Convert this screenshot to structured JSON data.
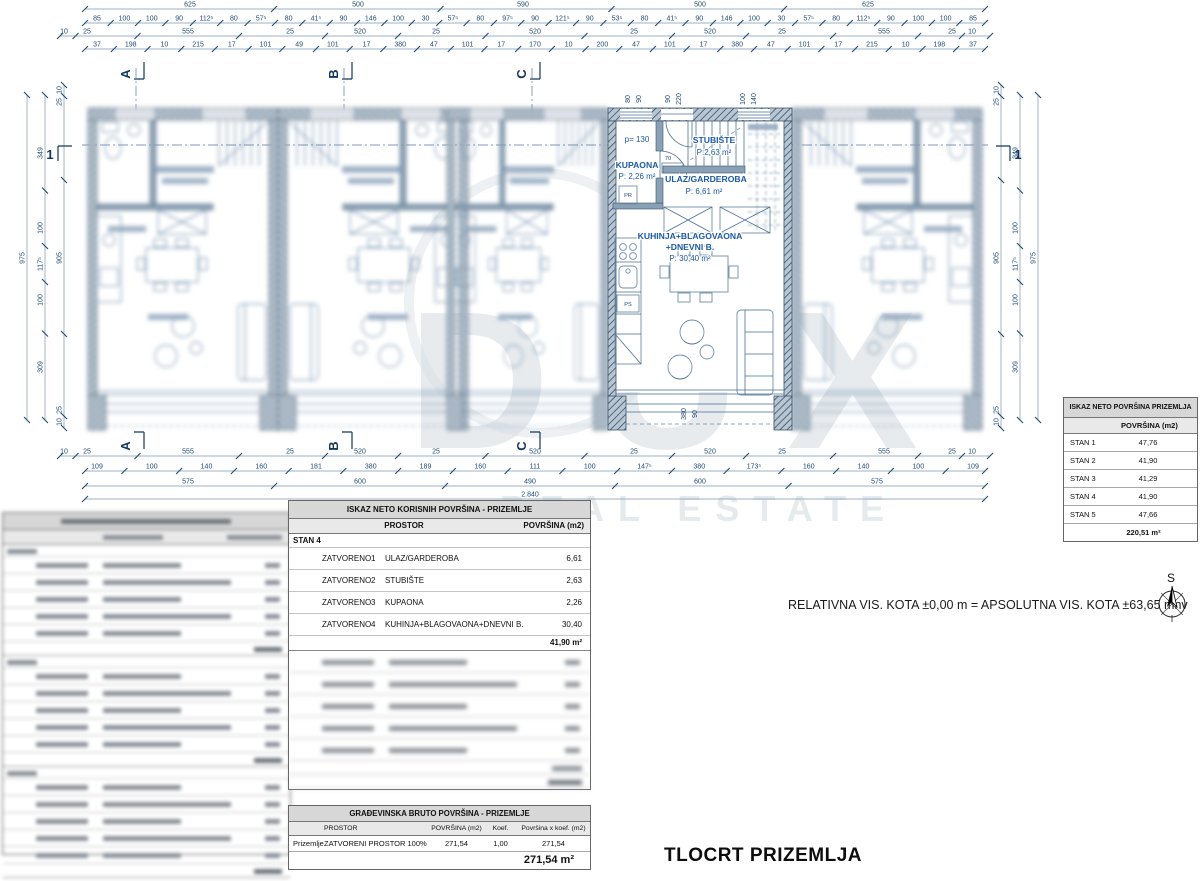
{
  "watermark": {
    "word": "DUX",
    "sub": "REAL ESTATE"
  },
  "page_title": "TLOCRT PRIZEMLJA",
  "kota_note": "RELATIVNA VIS. KOTA ±0,00 m = APSOLUTNA VIS. KOTA ±63,65 mnv",
  "compass_label": "S",
  "plan": {
    "markers": {
      "v": [
        "A",
        "B",
        "C"
      ],
      "h": "1"
    },
    "unit4": {
      "kupaona_p": "p= 130",
      "kupaona": "KUPAONA",
      "kupaona_area": "P: 2,26 m²",
      "pr": "PR",
      "stubiste": "STUBIŠTE",
      "stubiste_area": "P:2,63 m²",
      "ulaz": "ULAZ/GARDEROBA",
      "ulaz_area": "P: 6,61 m²",
      "kuhinja1": "KUHINJA+BLAGOVAONA",
      "kuhinja2": "+DNEVNI B.",
      "kuhinja_area": "P: 30,40 m²",
      "door_w": "70",
      "door_h": "215",
      "ps": "PS"
    },
    "dims": {
      "h": [
        {
          "y": 9,
          "span": [
            85,
            985
          ],
          "labels": [
            {
              "x": 190,
              "t": "625"
            },
            {
              "x": 358,
              "t": "500"
            },
            {
              "x": 523,
              "t": "590"
            },
            {
              "x": 700,
              "t": "500"
            },
            {
              "x": 868,
              "t": "625"
            }
          ]
        },
        {
          "y": 23,
          "span": [
            85,
            985
          ],
          "labels": [
            {
              "t": "85"
            },
            {
              "t": "100"
            },
            {
              "t": "100"
            },
            {
              "t": "90"
            },
            {
              "t": "112⁵"
            },
            {
              "t": "80"
            },
            {
              "t": "57⁵"
            },
            {
              "t": "80"
            },
            {
              "t": "41⁵"
            },
            {
              "t": "90"
            },
            {
              "t": "146"
            },
            {
              "t": "100"
            },
            {
              "t": "30"
            },
            {
              "t": "57⁵"
            },
            {
              "t": "80"
            },
            {
              "t": "97⁵"
            },
            {
              "t": "90"
            },
            {
              "t": "121⁵"
            },
            {
              "t": "90"
            },
            {
              "t": "53⁵"
            },
            {
              "t": "80"
            },
            {
              "t": "41⁵"
            },
            {
              "t": "90"
            },
            {
              "t": "146"
            },
            {
              "t": "100"
            },
            {
              "t": "30"
            },
            {
              "t": "57⁵"
            },
            {
              "t": "80"
            },
            {
              "t": "112⁵"
            },
            {
              "t": "90"
            },
            {
              "t": "100"
            },
            {
              "t": "100"
            },
            {
              "t": "85"
            }
          ]
        },
        {
          "y": 36,
          "span": [
            60,
            990
          ],
          "labels": [
            {
              "x": 64,
              "t": "10"
            },
            {
              "x": 87,
              "t": "25"
            },
            {
              "x": 188,
              "t": "555"
            },
            {
              "x": 290,
              "t": "25"
            },
            {
              "x": 360,
              "t": "520"
            },
            {
              "x": 436,
              "t": "25"
            },
            {
              "x": 535,
              "t": "520"
            },
            {
              "x": 634,
              "t": "25"
            },
            {
              "x": 710,
              "t": "520"
            },
            {
              "x": 782,
              "t": "25"
            },
            {
              "x": 884,
              "t": "555"
            },
            {
              "x": 952,
              "t": "25"
            },
            {
              "x": 972,
              "t": "10"
            }
          ]
        },
        {
          "y": 49,
          "span": [
            85,
            985
          ],
          "labels": [
            {
              "t": "37"
            },
            {
              "t": "198"
            },
            {
              "t": "10"
            },
            {
              "t": "215"
            },
            {
              "t": "17"
            },
            {
              "t": "101"
            },
            {
              "t": "49"
            },
            {
              "t": "101"
            },
            {
              "t": "17"
            },
            {
              "t": "380"
            },
            {
              "t": "47"
            },
            {
              "t": "101"
            },
            {
              "t": "17"
            },
            {
              "t": "170"
            },
            {
              "t": "10"
            },
            {
              "t": "200"
            },
            {
              "t": "47"
            },
            {
              "t": "101"
            },
            {
              "t": "17"
            },
            {
              "t": "380"
            },
            {
              "t": "47"
            },
            {
              "t": "101"
            },
            {
              "t": "17"
            },
            {
              "t": "215"
            },
            {
              "t": "10"
            },
            {
              "t": "198"
            },
            {
              "t": "37"
            }
          ]
        },
        {
          "y": 456,
          "span": [
            60,
            990
          ],
          "labels": [
            {
              "x": 64,
              "t": "10"
            },
            {
              "x": 87,
              "t": "25"
            },
            {
              "x": 188,
              "t": "555"
            },
            {
              "x": 290,
              "t": "25"
            },
            {
              "x": 360,
              "t": "520"
            },
            {
              "x": 436,
              "t": "25"
            },
            {
              "x": 535,
              "t": "520"
            },
            {
              "x": 634,
              "t": "25"
            },
            {
              "x": 710,
              "t": "520"
            },
            {
              "x": 782,
              "t": "25"
            },
            {
              "x": 884,
              "t": "555"
            },
            {
              "x": 952,
              "t": "25"
            },
            {
              "x": 972,
              "t": "10"
            }
          ]
        },
        {
          "y": 471,
          "span": [
            85,
            985
          ],
          "labels": [
            {
              "t": "109"
            },
            {
              "t": "100"
            },
            {
              "t": "140"
            },
            {
              "t": "160"
            },
            {
              "t": "181"
            },
            {
              "t": "380"
            },
            {
              "t": "189"
            },
            {
              "t": "160"
            },
            {
              "t": "111"
            },
            {
              "t": "100"
            },
            {
              "t": "147⁵"
            },
            {
              "t": "380"
            },
            {
              "t": "173⁵"
            },
            {
              "t": "160"
            },
            {
              "t": "140"
            },
            {
              "t": "100"
            },
            {
              "t": "109"
            }
          ]
        },
        {
          "y": 486,
          "span": [
            85,
            985
          ],
          "labels": [
            {
              "x": 188,
              "t": "575"
            },
            {
              "x": 360,
              "t": "600"
            },
            {
              "x": 530,
              "t": "490"
            },
            {
              "x": 700,
              "t": "600"
            },
            {
              "x": 877,
              "t": "575"
            }
          ]
        },
        {
          "y": 499,
          "span": [
            85,
            985
          ],
          "labels": [
            {
              "x": 530,
              "t": "2.840"
            }
          ]
        }
      ],
      "v": [
        {
          "x": 27,
          "span": [
            95,
            420
          ],
          "labels": [
            {
              "y": 258,
              "t": "975"
            }
          ]
        },
        {
          "x": 45,
          "span": [
            95,
            420
          ],
          "labels": [
            {
              "y": 153,
              "t": "349"
            },
            {
              "y": 228,
              "t": "100"
            },
            {
              "y": 264,
              "t": "117⁵"
            },
            {
              "y": 300,
              "t": "100"
            },
            {
              "y": 367,
              "t": "309"
            }
          ]
        },
        {
          "x": 64,
          "span": [
            85,
            428
          ],
          "labels": [
            {
              "y": 90,
              "t": "10"
            },
            {
              "y": 102,
              "t": "25"
            },
            {
              "y": 258,
              "t": "905"
            },
            {
              "y": 410,
              "t": "25"
            },
            {
              "y": 422,
              "t": "10"
            }
          ]
        },
        {
          "x": 1001,
          "span": [
            85,
            428
          ],
          "labels": [
            {
              "y": 90,
              "t": "10"
            },
            {
              "y": 102,
              "t": "25"
            },
            {
              "y": 258,
              "t": "905"
            },
            {
              "y": 410,
              "t": "25"
            },
            {
              "y": 422,
              "t": "10"
            }
          ]
        },
        {
          "x": 1020,
          "span": [
            95,
            420
          ],
          "labels": [
            {
              "y": 153,
              "t": "349"
            },
            {
              "y": 228,
              "t": "100"
            },
            {
              "y": 264,
              "t": "117⁵"
            },
            {
              "y": 300,
              "t": "100"
            },
            {
              "y": 367,
              "t": "309"
            }
          ]
        },
        {
          "x": 1038,
          "span": [
            95,
            420
          ],
          "labels": [
            {
              "y": 258,
              "t": "975"
            }
          ]
        }
      ],
      "rot": [
        {
          "x": 630,
          "y": 99,
          "t": "80"
        },
        {
          "x": 641,
          "y": 99,
          "t": "90"
        },
        {
          "x": 670,
          "y": 99,
          "t": "90"
        },
        {
          "x": 681,
          "y": 99,
          "t": "220"
        },
        {
          "x": 745,
          "y": 99,
          "t": "100"
        },
        {
          "x": 756,
          "y": 99,
          "t": "140"
        },
        {
          "x": 686,
          "y": 414,
          "t": "380"
        },
        {
          "x": 697,
          "y": 414,
          "t": "90"
        }
      ]
    }
  },
  "right_table": {
    "title": "ISKAZ NETO POVRŠINA PRIZEMLJA",
    "col": "POVRŠINA (m2)",
    "rows": [
      {
        "label": "STAN 1",
        "value": "47,76"
      },
      {
        "label": "STAN 2",
        "value": "41,90"
      },
      {
        "label": "STAN 3",
        "value": "41,29"
      },
      {
        "label": "STAN 4",
        "value": "41,90"
      },
      {
        "label": "STAN 5",
        "value": "47,66"
      }
    ],
    "total": "220,51 m²"
  },
  "net_table": {
    "title": "ISKAZ NETO KORISNIH POVRŠINA - PRIZEMLJE",
    "col1": "PROSTOR",
    "col2": "POVRŠINA (m2)",
    "section": "STAN 4",
    "rows": [
      {
        "type": "ZATVORENO",
        "num": "1",
        "name": "ULAZ/GARDEROBA",
        "value": "6,61"
      },
      {
        "type": "ZATVORENO",
        "num": "2",
        "name": "STUBIŠTE",
        "value": "2,63"
      },
      {
        "type": "ZATVORENO",
        "num": "3",
        "name": "KUPAONA",
        "value": "2,26"
      },
      {
        "type": "ZATVORENO",
        "num": "4",
        "name": "KUHINJA+BLAGOVAONA+DNEVNI B.",
        "value": "30,40"
      }
    ],
    "total": "41,90 m²",
    "blurred_rows": 5
  },
  "bruto_table": {
    "title": "GRAĐEVINSKA BRUTO POVRŠINA - PRIZEMLJE",
    "cols": [
      "PROSTOR",
      "POVRŠINA (m2)",
      "Koef.",
      "Površina x koef. (m2)"
    ],
    "row": {
      "c0": "Prizemlje",
      "c1": "ZATVORENI PROSTOR 100%",
      "c2": "271,54",
      "c3": "1,00",
      "c4": "271,54"
    },
    "total": "271,54 m²"
  },
  "left_table_blurred": {
    "sections": 3,
    "rows_per_section": 5
  }
}
